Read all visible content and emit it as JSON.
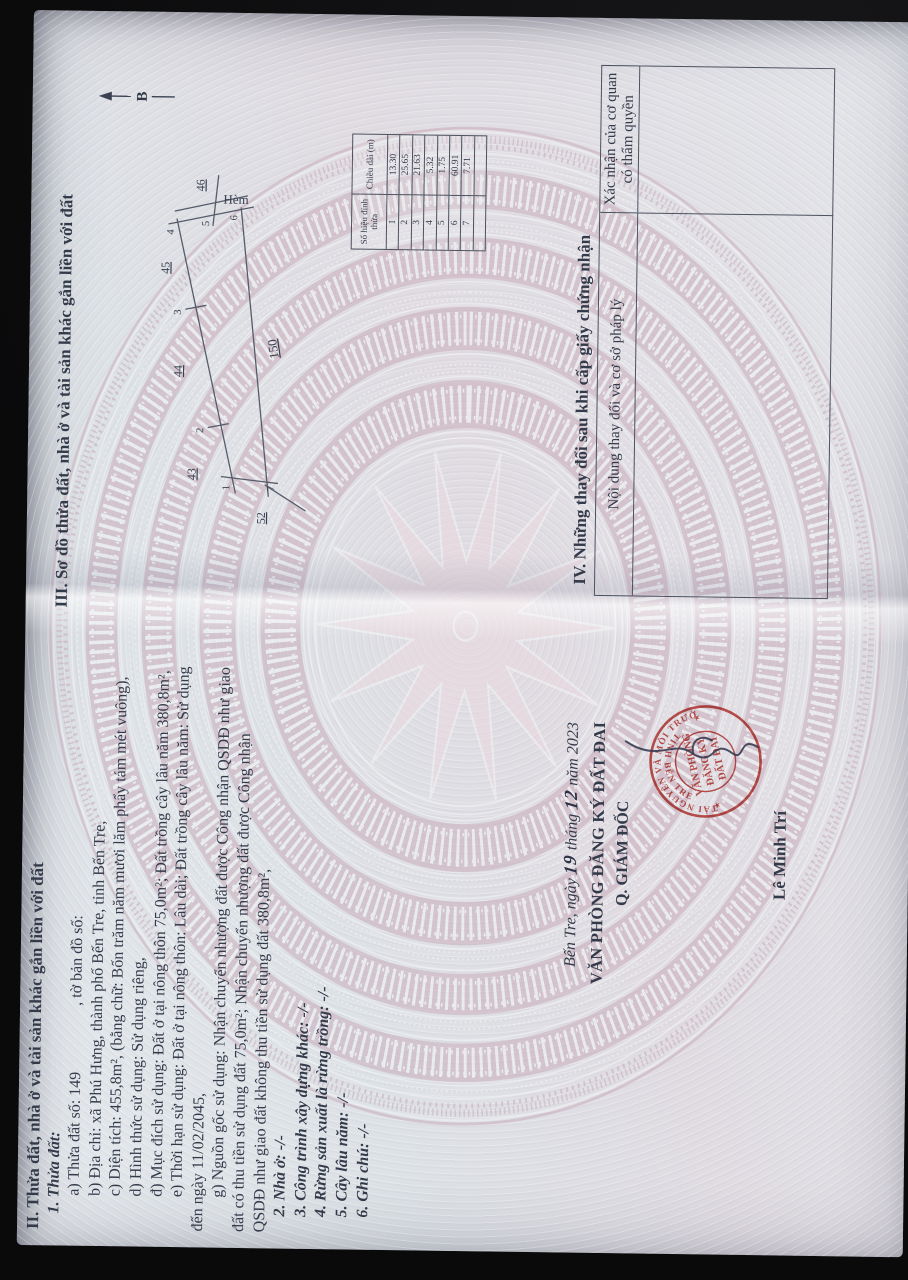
{
  "certificate": {
    "section2": {
      "heading": "II. Thửa đất, nhà ở và tài sản khác gắn liền với đất",
      "sub_heading": "1. Thửa đất:",
      "line_a_main": "a) Thửa đất số: 149",
      "line_a_tail": ", tờ bản đồ số:",
      "line_b": "b) Địa chỉ: xã Phú Hưng, thành phố Bến Tre, tỉnh Bến Tre,",
      "line_c": "c) Diện tích: 455,8m², (bằng chữ: Bốn trăm năm mươi lăm phẩy tám mét vuông),",
      "line_d": "d) Hình thức sử dụng: Sử dụng riêng,",
      "line_dd": "đ) Mục đích sử dụng: Đất ở tại nông thôn 75,0m²; Đất trồng cây lâu năm 380,8m²,",
      "line_e": "e) Thời hạn sử dụng: Đất ở tại nông thôn: Lâu dài; Đất trồng cây lâu năm: Sử dụng",
      "line_e2": "đến ngày 11/02/2045,",
      "line_g": "g) Nguồn gốc sử dụng: Nhận chuyển nhượng đất được Công nhận QSDĐ như giao",
      "line_g2": "đất có thu tiền sử dụng đất 75,0m²; Nhận chuyển nhượng đất được Công nhận",
      "line_g3": "QSDĐ như giao đất không thu tiền sử dụng đất 380,8m²,",
      "item2": "2. Nhà ở: -/-",
      "item3": "3. Công trình xây dựng khác: -/-",
      "item4": "4. Rừng sản xuất là rừng trồng: -/-",
      "item5": "5. Cây lâu năm: -/-",
      "item6": "6. Ghi chú: -/-"
    },
    "section3": {
      "heading": "III. Sơ đồ thửa đất, nhà ở và tài sản khác gắn liền với đất",
      "north_label": "B",
      "sketch": {
        "parcel_number": "150",
        "alley_label": "Hèm",
        "neighbor_43": "43",
        "neighbor_44": "44",
        "neighbor_45": "45",
        "neighbor_46": "46",
        "neighbor_52": "52",
        "v1": "1",
        "v2": "2",
        "v3": "3",
        "v4": "4",
        "v5": "5",
        "v6": "6",
        "v7": "7"
      },
      "vertex_table": {
        "col1_header": "Số hiệu đỉnh thửa",
        "col2_header": "Chiều dài (m)",
        "rows": [
          [
            "1",
            "13.30"
          ],
          [
            "2",
            "25.65"
          ],
          [
            "3",
            "21.63"
          ],
          [
            "4",
            "5.32"
          ],
          [
            "5",
            "1.75"
          ],
          [
            "6",
            "60.91"
          ],
          [
            "7",
            "7.71"
          ],
          [
            "",
            ""
          ]
        ]
      }
    },
    "section4": {
      "heading": "IV. Những thay đổi sau khi cấp giấy chứng nhận",
      "col1_header": "Nội dung thay đổi và cơ sở pháp lý",
      "col2_header": "Xác nhận của cơ quan có thẩm quyền"
    },
    "signature": {
      "place_prefix": "Bến Tre, ngày",
      "day": "19",
      "month_word": "tháng",
      "month": "12",
      "year_word": "năm 2023",
      "office": "VĂN PHÒNG ĐĂNG KÝ ĐẤT ĐAI",
      "role": "Q. GIÁM ĐỐC",
      "signer_name": "Lê Minh Trí",
      "seal_ring_top": "SỞ TÀI NGUYÊN VÀ MÔI TRƯỜNG",
      "seal_ring_bottom": "TỈNH BẾN TRE",
      "seal_center_1": "VĂN PHÒNG",
      "seal_center_2": "ĐĂNG KÝ",
      "seal_center_3": "ĐẤT ĐAI",
      "seal_star": "★"
    },
    "colors": {
      "seal_red": "#c2423c",
      "pattern_mauve": "#c9adbb",
      "paper": "#dde2e6",
      "ink": "#333a4a"
    }
  }
}
